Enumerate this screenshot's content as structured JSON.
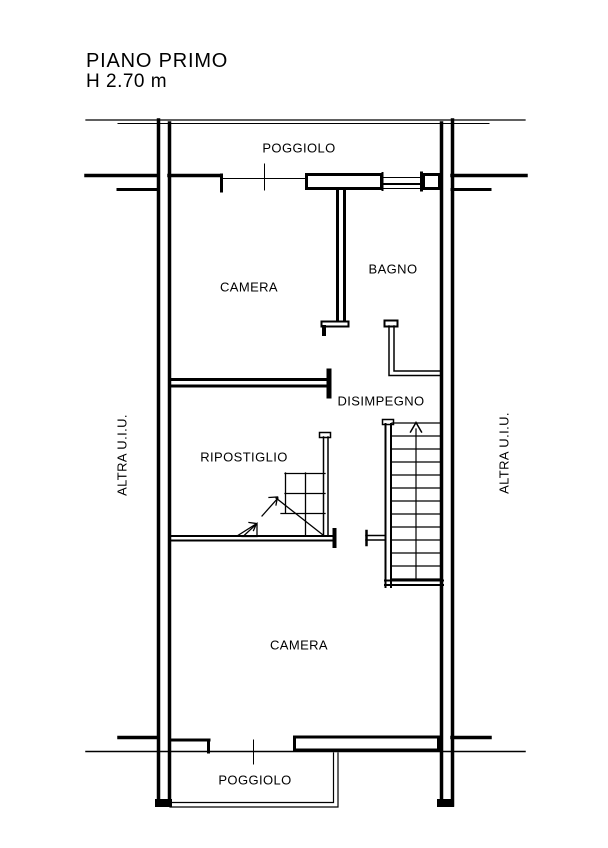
{
  "title": "PIANO PRIMO",
  "height_label": "H 2.70 m",
  "rooms": {
    "poggiolo_top": "POGGIOLO",
    "camera_top": "CAMERA",
    "bagno": "BAGNO",
    "disimpegno": "DISIMPEGNO",
    "ripostiglio": "RIPOSTIGLIO",
    "camera_bottom": "CAMERA",
    "poggiolo_bottom": "POGGIOLO"
  },
  "adjacent_units": {
    "left": "ALTRA U.I.U.",
    "right": "ALTRA U.I.U."
  },
  "icons": {
    "stair_direction": "up-arrow"
  },
  "colors": {
    "line": "#000000",
    "background": "#ffffff"
  }
}
